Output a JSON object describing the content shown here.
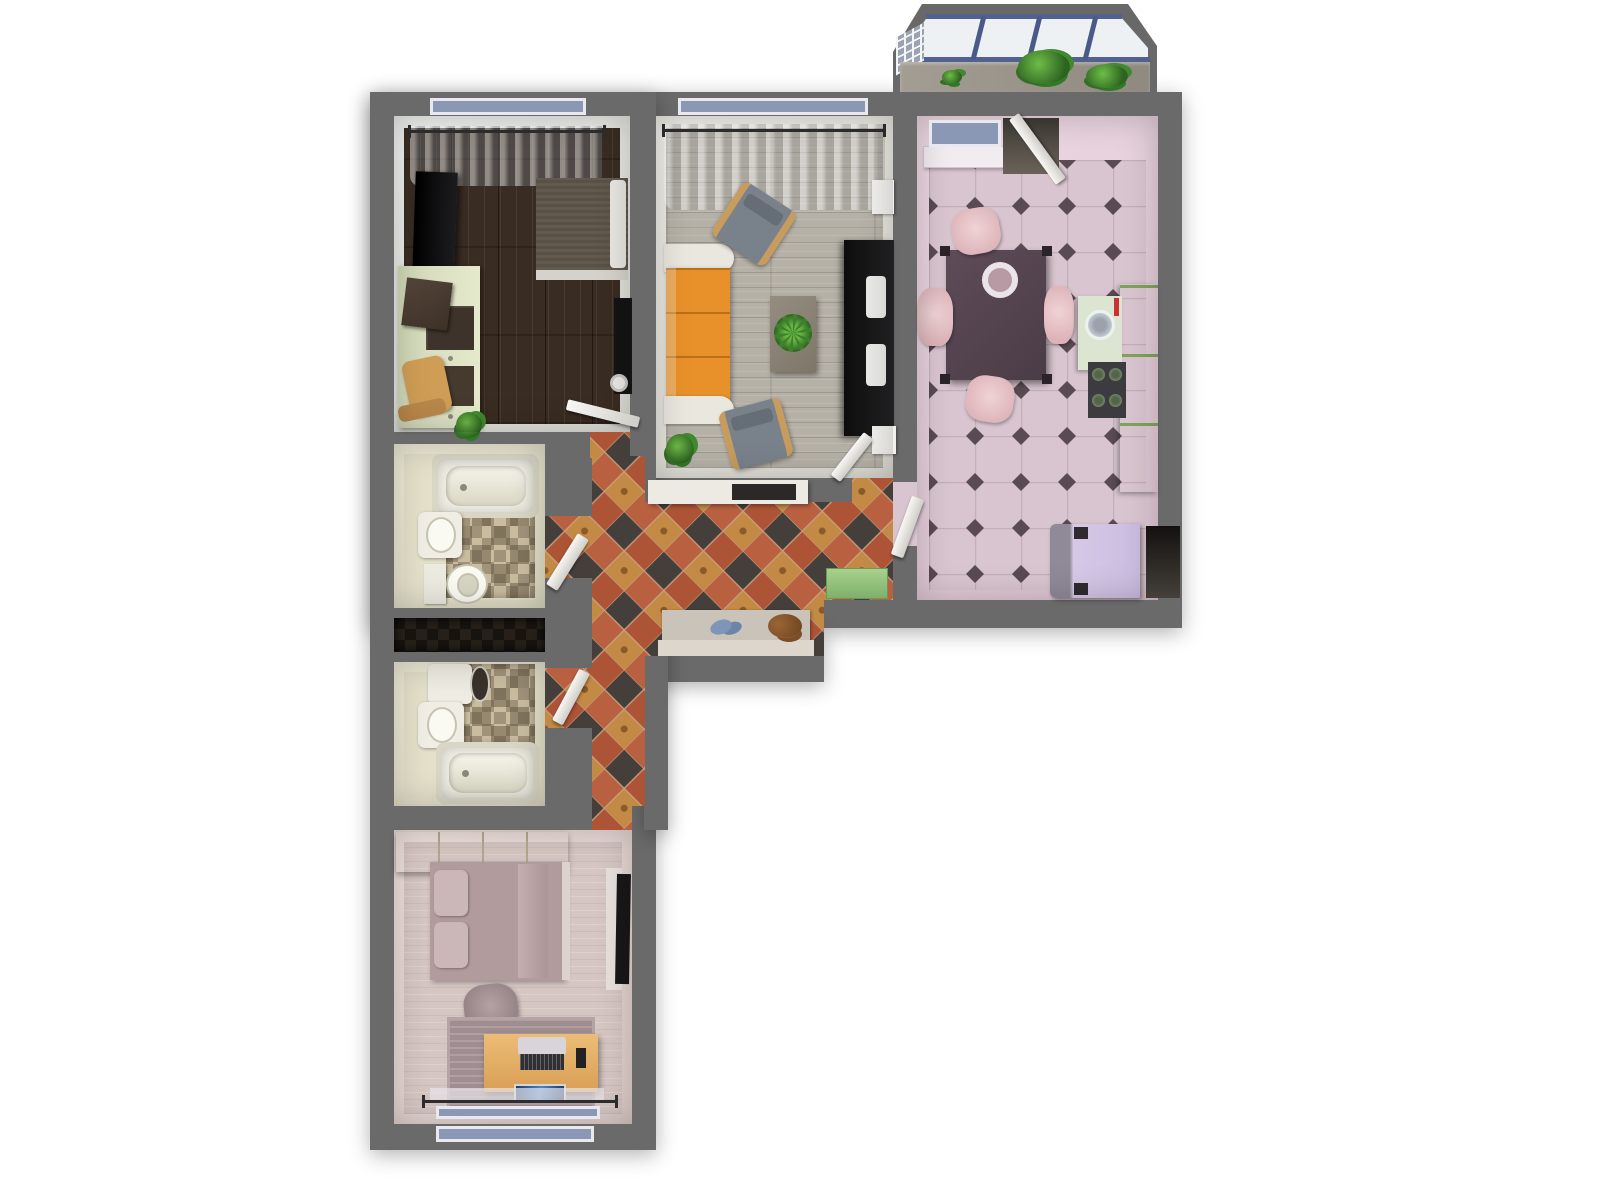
{
  "scene": {
    "title": "Apartment floor plan - top-down 3D render",
    "background": "#ffffff",
    "wall_color": "#6a6a6a"
  },
  "rooms": {
    "bedroom1": {
      "label": "Bedroom (top left)",
      "floor": "dark walnut planks",
      "items": {
        "curtain": "gray window curtains",
        "tv": "wall-mounted TV",
        "bed": "double bed with gray blanket and white pillows",
        "sideboard": "pale green sideboard with books",
        "chair": "wooden chair",
        "plant": "potted plant",
        "lamp": "dark floor lamp",
        "door": "white door to hallway"
      }
    },
    "living": {
      "label": "Living room",
      "floor": "gray wood planks",
      "items": {
        "curtain": "sheer curtain",
        "sofa": "orange three-seat sofa with white armrests",
        "armchair_top": "gray armchair",
        "armchair_bottom": "gray armchair",
        "coffee_table": "coffee table with green plant",
        "tv_unit": "black TV media wall",
        "speaker_top": "white speaker",
        "speaker_bottom": "white speaker",
        "plant": "floor plant",
        "door": "white door to hallway"
      }
    },
    "kitchen": {
      "label": "Kitchen",
      "floor": "pink ceramic tiles with dark diamonds",
      "items": {
        "window": "window with sill",
        "balcony_door": "open balcony door",
        "table": "dark dining table with plate",
        "chairs": "four pink chairs",
        "counter": "green kitchen counter",
        "sink": "round sink with red faucet",
        "stove": "four-burner stove",
        "fridge": "lavender fridge",
        "niche": "dark utility niche",
        "door": "white door to hallway"
      }
    },
    "hallway": {
      "label": "Entrance hall",
      "floor": "terracotta, slate and gold diamond tiles",
      "items": {
        "shelf": "white wall shelf with dark box",
        "bench": "shoe bench with blue slippers and brown shoes",
        "mat": "green entrance mat",
        "bath1_door": "upper bathroom door",
        "bath2_door": "lower bathroom door",
        "kitchen_door": "kitchen door"
      }
    },
    "bathroom1": {
      "label": "Bathroom (upper)",
      "floor": "beige mosaic tiles",
      "items": {
        "tub": "bathtub",
        "sink": "washbasin",
        "toilet": "toilet"
      }
    },
    "storage": {
      "label": "Dark storage niche"
    },
    "bathroom2": {
      "label": "Bathroom (lower)",
      "floor": "beige mosaic tiles",
      "items": {
        "toilet": "toilet with open dark lid",
        "sink": "washbasin",
        "tub": "bathtub"
      }
    },
    "bedroom2": {
      "label": "Bedroom (bottom)",
      "floor": "rose-tinted wood planks",
      "items": {
        "wardrobe": "built-in wardrobe",
        "bed": "double bed with mauve bedding and pillows",
        "tv": "wall TV panel",
        "chair": "desk chair",
        "rug": "striped mauve rug",
        "desk": "wooden desk with laptop",
        "window": "window with curtain rod"
      }
    },
    "balcony": {
      "label": "Glazed balcony",
      "items": {
        "glazing": "blue-framed window glazing",
        "lattice": "white lattice panel",
        "sill": "speckled balcony sill",
        "plants": "green plants"
      }
    }
  },
  "palette": {
    "wall": "#6a6a6a",
    "bedroom1_floor": "#392c22",
    "living_floor": "#b5b1a7",
    "kitchen_tile": "#d9c5cf",
    "kitchen_diamond": "#5a4a52",
    "hall_tile_base": "#b2573a",
    "hall_tile_dark": "#453f3b",
    "hall_tile_gold": "#c28a45",
    "mosaic_base": "#b3a488",
    "bedroom2_floor": "#d6c6c2",
    "sofa_orange": "#e8912a",
    "counter_green": "#b7d98b",
    "mat_green": "#8fc17c",
    "fridge_lavender": "#cfc2e2",
    "balcony_frame_blue": "#516190"
  }
}
